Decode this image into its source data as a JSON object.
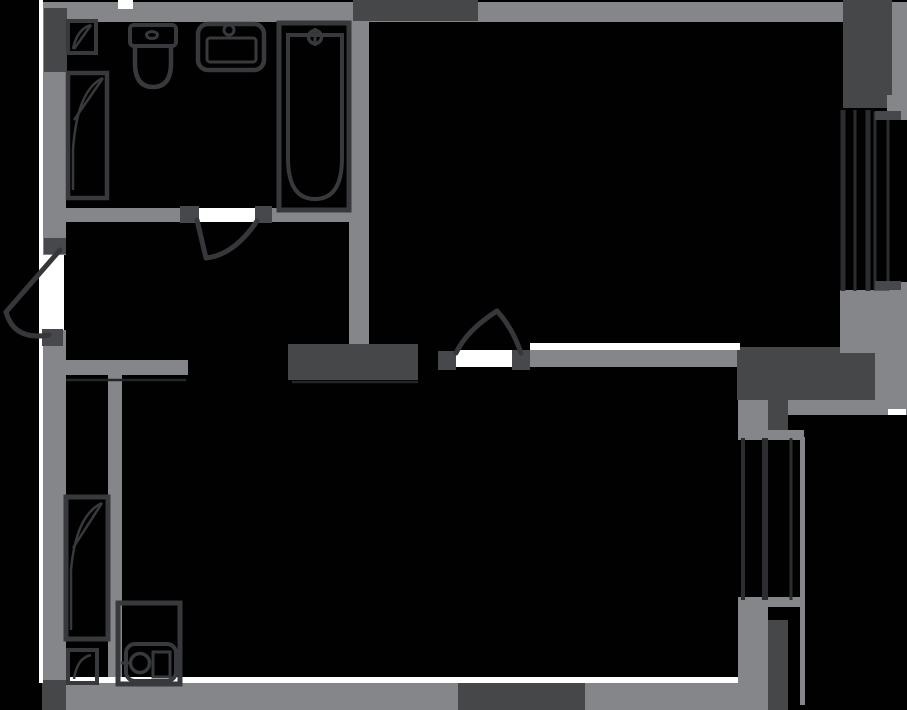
{
  "document": {
    "type": "apartment-floor-plan",
    "canvas": {
      "width": 907,
      "height": 710
    }
  },
  "colors": {
    "background": "#010101",
    "wall_light": "#84868a",
    "wall_dark": "#454749",
    "opening_white": "#ffffff",
    "outline": "#37393c",
    "door_line": "#35373a",
    "jamb_dark": "#47484b",
    "window_line": "#2b2d30",
    "detail_line": "#232527"
  },
  "rooms": [
    {
      "id": "bathroom",
      "position": "top-left"
    },
    {
      "id": "hallway",
      "position": "middle-left"
    },
    {
      "id": "bedroom",
      "position": "top-right"
    },
    {
      "id": "living-kitchen",
      "position": "bottom"
    },
    {
      "id": "closet-niche",
      "position": "bottom-left"
    },
    {
      "id": "balcony",
      "position": "right-edge"
    }
  ],
  "doors": [
    {
      "id": "entrance-door",
      "wall": "left",
      "swing": "outward"
    },
    {
      "id": "bathroom-door",
      "wall": "bathroom-south",
      "swing": "into-hallway"
    },
    {
      "id": "bedroom-door",
      "wall": "bedroom-south",
      "swing": "into-bedroom"
    }
  ],
  "windows": [
    {
      "id": "bedroom-window",
      "wall": "right",
      "panes": 3
    },
    {
      "id": "living-window",
      "wall": "right",
      "panes": 3
    }
  ],
  "fixtures": [
    {
      "id": "corner-cabinet",
      "room": "bathroom"
    },
    {
      "id": "tall-cabinet",
      "room": "bathroom"
    },
    {
      "id": "toilet",
      "room": "bathroom"
    },
    {
      "id": "sink",
      "room": "bathroom"
    },
    {
      "id": "bathtub",
      "room": "bathroom"
    },
    {
      "id": "wardrobe",
      "room": "closet-niche"
    },
    {
      "id": "small-cabinet",
      "room": "closet-niche"
    },
    {
      "id": "washer-sink-unit",
      "room": "living-kitchen"
    }
  ]
}
